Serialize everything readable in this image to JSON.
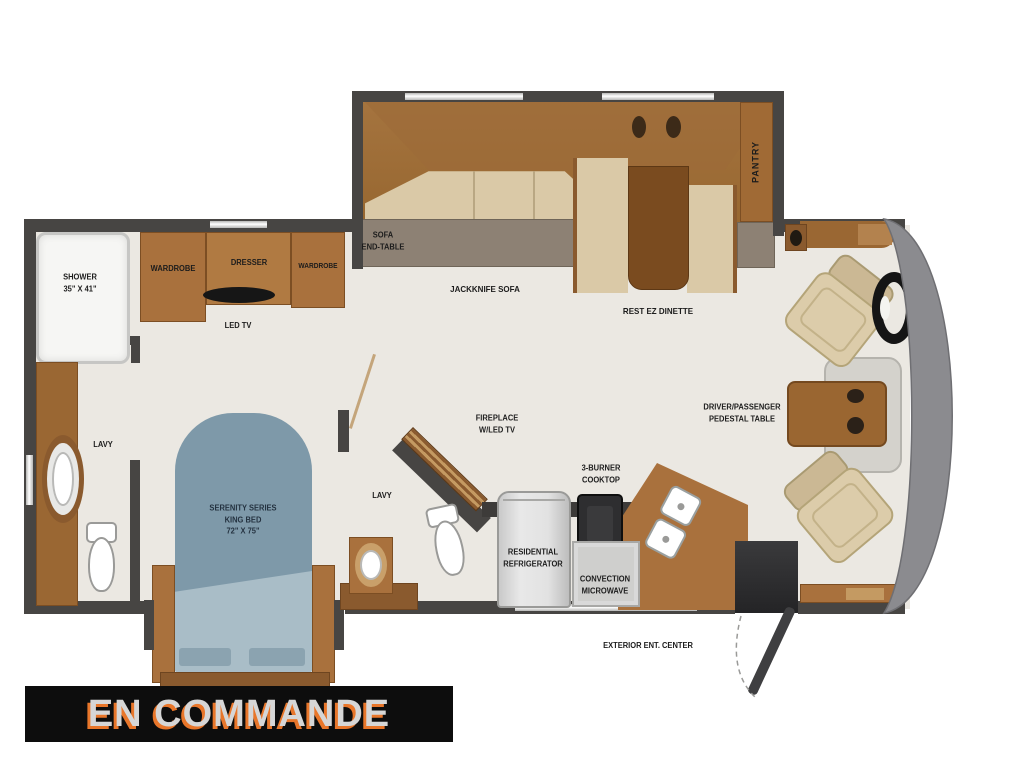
{
  "banner": {
    "label": "EN COMMANDE",
    "bg": "#0d0d0d",
    "text_color": "#d6d6d6",
    "shadow_color": "#e8762a"
  },
  "palette": {
    "wall": "#474543",
    "floor": "#ebe8e2",
    "wood": "#a9713d",
    "wood_dark": "#8a5a2e",
    "cushion": "#dac9a7",
    "bed_blue": "#7e99a9",
    "cab_gray": "#8b8b8f"
  },
  "floorplan": {
    "rear_bath": {
      "shower_label": "SHOWER\n35\" X 41\"",
      "lavy_label": "LAVY"
    },
    "bedroom": {
      "wardrobe_left_label": "WARDROBE",
      "dresser_label": "DRESSER",
      "wardrobe_right_label": "WARDROBE",
      "tv_label": "LED TV",
      "bed_label": "SERENITY SERIES\nKING BED\n72\" X 75\""
    },
    "mid_bath": {
      "lavy_label": "LAVY",
      "fireplace_label": "FIREPLACE\nW/LED TV"
    },
    "living": {
      "sofa_end_table_label": "SOFA\nEND-TABLE",
      "sofa_label": "JACKKNIFE SOFA",
      "dinette_label": "REST EZ DINETTE",
      "pantry_label": "PANTRY"
    },
    "kitchen": {
      "cooktop_label": "3-BURNER\nCOOKTOP",
      "refrigerator_label": "RESIDENTIAL\nREFRIGERATOR",
      "microwave_label": "CONVECTION\nMICROWAVE",
      "exterior_label": "EXTERIOR ENT. CENTER"
    },
    "cab": {
      "pedestal_label": "DRIVER/PASSENGER\nPEDESTAL TABLE"
    }
  }
}
